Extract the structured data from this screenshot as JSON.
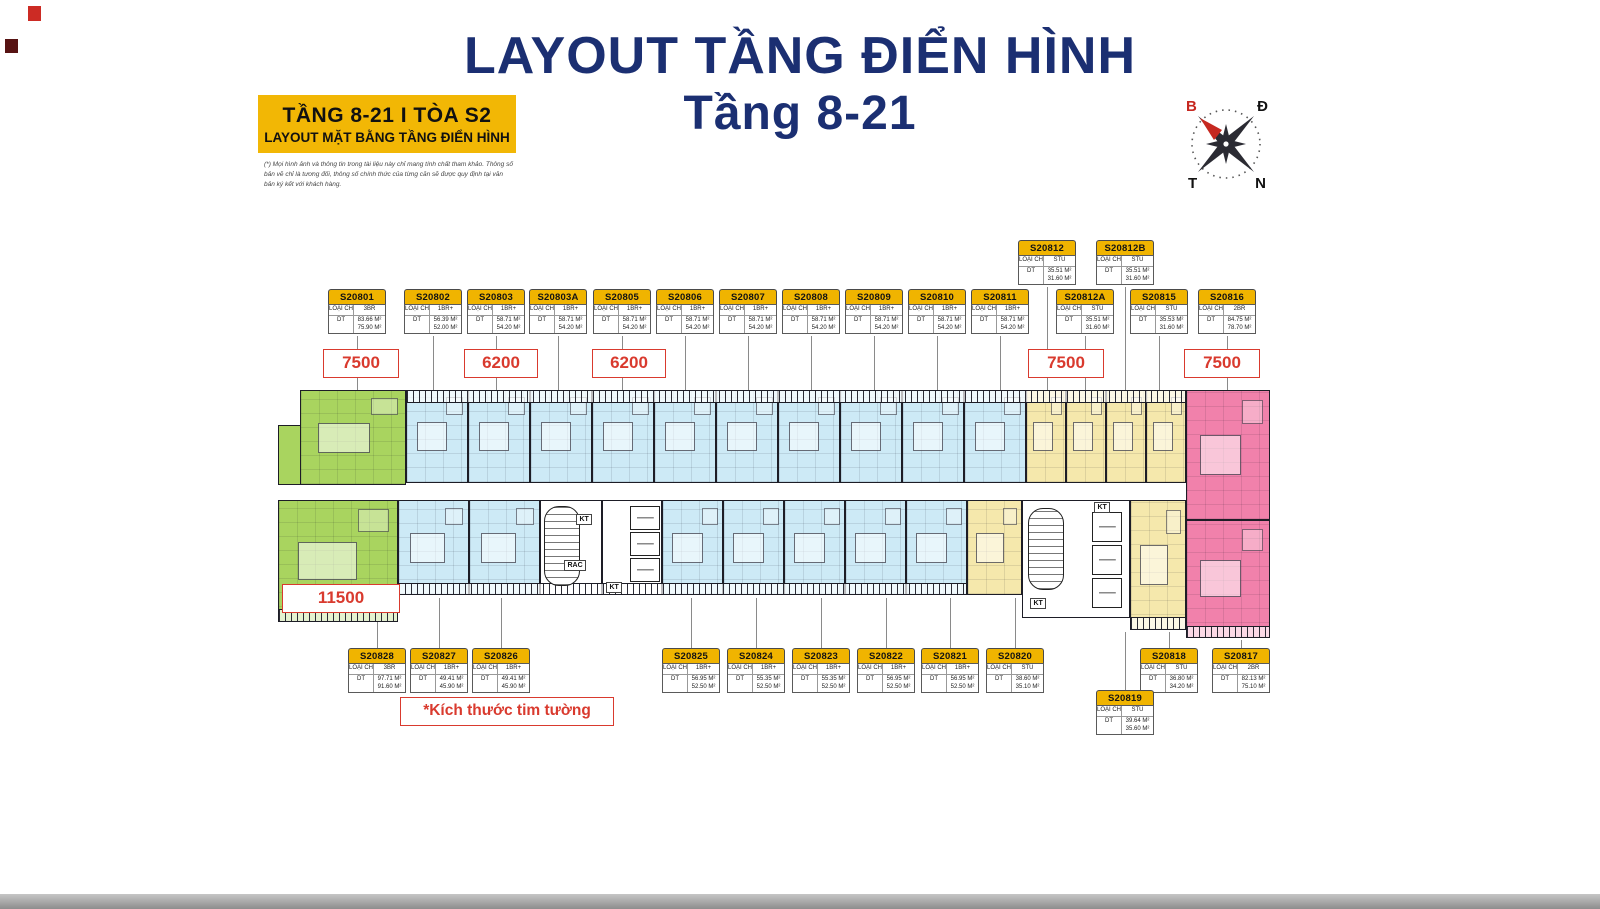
{
  "page": {
    "title_line1": "LAYOUT TẦNG ĐIỂN HÌNH",
    "title_line2": "Tầng 8-21"
  },
  "badge": {
    "line1": "TẦNG 8-21 I TÒA S2",
    "line2": "LAYOUT MẶT BẰNG TẦNG ĐIỂN HÌNH",
    "disclaimer": "(*) Mọi hình ảnh và thông tin trong tài liệu này chỉ mang tính chất tham khảo. Thông số bản vẽ chỉ là tương đối, thông số chính thức của từng căn sẽ được quy định tại văn bản ký kết với khách hàng."
  },
  "compass": {
    "north": "B",
    "east": "Đ",
    "west": "T",
    "south": "N"
  },
  "note": {
    "text": "*Kích thước tim tường"
  },
  "table_labels": {
    "type_label": "LOẠI CH",
    "area_label": "DT"
  },
  "colors": {
    "title_navy": "#1b2f72",
    "card_header_gold": "#f0b400",
    "badge_gold": "#f2b705",
    "dim_red": "#d93a2e",
    "unit_green": "#a9d45f",
    "unit_blue": "#cdeaf6",
    "unit_yellow": "#f5e8ac",
    "unit_pink": "#f181ab"
  },
  "units": [
    {
      "id": "S20801",
      "type": "3BR",
      "area1": "83.66 M²",
      "area2": "75.90 M²",
      "x": 328,
      "y": 289,
      "ly1": 336,
      "ly2": 390
    },
    {
      "id": "S20802",
      "type": "1BR+",
      "area1": "56.39 M²",
      "area2": "52.00 M²",
      "x": 404,
      "y": 289,
      "ly1": 336,
      "ly2": 390
    },
    {
      "id": "S20803",
      "type": "1BR+",
      "area1": "58.71 M²",
      "area2": "54.20 M²",
      "x": 467,
      "y": 289,
      "ly1": 336,
      "ly2": 390
    },
    {
      "id": "S20803A",
      "type": "1BR+",
      "area1": "58.71 M²",
      "area2": "54.20 M²",
      "x": 529,
      "y": 289,
      "ly1": 336,
      "ly2": 390
    },
    {
      "id": "S20805",
      "type": "1BR+",
      "area1": "58.71 M²",
      "area2": "54.20 M²",
      "x": 593,
      "y": 289,
      "ly1": 336,
      "ly2": 390
    },
    {
      "id": "S20806",
      "type": "1BR+",
      "area1": "58.71 M²",
      "area2": "54.20 M²",
      "x": 656,
      "y": 289,
      "ly1": 336,
      "ly2": 390
    },
    {
      "id": "S20807",
      "type": "1BR+",
      "area1": "58.71 M²",
      "area2": "54.20 M²",
      "x": 719,
      "y": 289,
      "ly1": 336,
      "ly2": 390
    },
    {
      "id": "S20808",
      "type": "1BR+",
      "area1": "58.71 M²",
      "area2": "54.20 M²",
      "x": 782,
      "y": 289,
      "ly1": 336,
      "ly2": 390
    },
    {
      "id": "S20809",
      "type": "1BR+",
      "area1": "58.71 M²",
      "area2": "54.20 M²",
      "x": 845,
      "y": 289,
      "ly1": 336,
      "ly2": 390
    },
    {
      "id": "S20810",
      "type": "1BR+",
      "area1": "58.71 M²",
      "area2": "54.20 M²",
      "x": 908,
      "y": 289,
      "ly1": 336,
      "ly2": 390
    },
    {
      "id": "S20811",
      "type": "1BR+",
      "area1": "58.71 M²",
      "area2": "54.20 M²",
      "x": 971,
      "y": 289,
      "ly1": 336,
      "ly2": 390
    },
    {
      "id": "S20812",
      "type": "STU",
      "area1": "35.51 M²",
      "area2": "31.60 M²",
      "x": 1018,
      "y": 240,
      "ly1": 287,
      "ly2": 390
    },
    {
      "id": "S20812B",
      "type": "STU",
      "area1": "35.51 M²",
      "area2": "31.60 M²",
      "x": 1096,
      "y": 240,
      "ly1": 287,
      "ly2": 390
    },
    {
      "id": "S20812A",
      "type": "STU",
      "area1": "35.51 M²",
      "area2": "31.60 M²",
      "x": 1056,
      "y": 289,
      "ly1": 336,
      "ly2": 390
    },
    {
      "id": "S20815",
      "type": "STU",
      "area1": "35.53 M²",
      "area2": "31.60 M²",
      "x": 1130,
      "y": 289,
      "ly1": 336,
      "ly2": 390
    },
    {
      "id": "S20816",
      "type": "2BR",
      "area1": "84.75 M²",
      "area2": "78.70 M²",
      "x": 1198,
      "y": 289,
      "ly1": 336,
      "ly2": 390
    },
    {
      "id": "S20828",
      "type": "3BR",
      "area1": "97.71 M²",
      "area2": "91.60 M²",
      "x": 348,
      "y": 648,
      "ly1": 615,
      "ly2": 648
    },
    {
      "id": "S20827",
      "type": "1BR+",
      "area1": "49.41 M²",
      "area2": "45.90 M²",
      "x": 410,
      "y": 648,
      "ly1": 598,
      "ly2": 648
    },
    {
      "id": "S20826",
      "type": "1BR+",
      "area1": "49.41 M²",
      "area2": "45.90 M²",
      "x": 472,
      "y": 648,
      "ly1": 598,
      "ly2": 648
    },
    {
      "id": "S20825",
      "type": "1BR+",
      "area1": "56.95 M²",
      "area2": "52.50 M²",
      "x": 662,
      "y": 648,
      "ly1": 598,
      "ly2": 648
    },
    {
      "id": "S20824",
      "type": "1BR+",
      "area1": "55.35 M²",
      "area2": "52.50 M²",
      "x": 727,
      "y": 648,
      "ly1": 598,
      "ly2": 648
    },
    {
      "id": "S20823",
      "type": "1BR+",
      "area1": "55.35 M²",
      "area2": "52.50 M²",
      "x": 792,
      "y": 648,
      "ly1": 598,
      "ly2": 648
    },
    {
      "id": "S20822",
      "type": "1BR+",
      "area1": "56.95 M²",
      "area2": "52.50 M²",
      "x": 857,
      "y": 648,
      "ly1": 598,
      "ly2": 648
    },
    {
      "id": "S20821",
      "type": "1BR+",
      "area1": "56.95 M²",
      "area2": "52.50 M²",
      "x": 921,
      "y": 648,
      "ly1": 598,
      "ly2": 648
    },
    {
      "id": "S20820",
      "type": "STU",
      "area1": "38.60 M²",
      "area2": "35.10 M²",
      "x": 986,
      "y": 648,
      "ly1": 598,
      "ly2": 648
    },
    {
      "id": "S20818",
      "type": "STU",
      "area1": "36.80 M²",
      "area2": "34.20 M²",
      "x": 1140,
      "y": 648,
      "ly1": 632,
      "ly2": 648
    },
    {
      "id": "S20817",
      "type": "2BR",
      "area1": "82.13 M²",
      "area2": "75.10 M²",
      "x": 1212,
      "y": 648,
      "ly1": 640,
      "ly2": 648
    },
    {
      "id": "S20819",
      "type": "STU",
      "area1": "39.64 M²",
      "area2": "35.60 M²",
      "x": 1096,
      "y": 690,
      "ly1": 632,
      "ly2": 690
    }
  ],
  "dimensions": [
    {
      "label": "7500",
      "x": 323,
      "y": 349,
      "w": 74
    },
    {
      "label": "6200",
      "x": 464,
      "y": 349,
      "w": 72
    },
    {
      "label": "6200",
      "x": 592,
      "y": 349,
      "w": 72
    },
    {
      "label": "7500",
      "x": 1028,
      "y": 349,
      "w": 74
    },
    {
      "label": "7500",
      "x": 1184,
      "y": 349,
      "w": 74
    },
    {
      "label": "11500",
      "x": 282,
      "y": 584,
      "w": 116
    }
  ],
  "plan": {
    "blocks": [
      {
        "x": 300,
        "y": 390,
        "w": 106,
        "h": 95,
        "c": "green",
        "tex": true
      },
      {
        "x": 278,
        "y": 425,
        "w": 23,
        "h": 60,
        "c": "green",
        "tex": false
      },
      {
        "x": 406,
        "y": 390,
        "w": 62,
        "h": 93,
        "c": "blue",
        "tex": true
      },
      {
        "x": 468,
        "y": 390,
        "w": 62,
        "h": 93,
        "c": "blue",
        "tex": true
      },
      {
        "x": 530,
        "y": 390,
        "w": 62,
        "h": 93,
        "c": "blue",
        "tex": true
      },
      {
        "x": 592,
        "y": 390,
        "w": 62,
        "h": 93,
        "c": "blue",
        "tex": true
      },
      {
        "x": 654,
        "y": 390,
        "w": 62,
        "h": 93,
        "c": "blue",
        "tex": true
      },
      {
        "x": 716,
        "y": 390,
        "w": 62,
        "h": 93,
        "c": "blue",
        "tex": true
      },
      {
        "x": 778,
        "y": 390,
        "w": 62,
        "h": 93,
        "c": "blue",
        "tex": true
      },
      {
        "x": 840,
        "y": 390,
        "w": 62,
        "h": 93,
        "c": "blue",
        "tex": true
      },
      {
        "x": 902,
        "y": 390,
        "w": 62,
        "h": 93,
        "c": "blue",
        "tex": true
      },
      {
        "x": 964,
        "y": 390,
        "w": 62,
        "h": 93,
        "c": "blue",
        "tex": true
      },
      {
        "x": 1026,
        "y": 390,
        "w": 40,
        "h": 93,
        "c": "yellow",
        "tex": true
      },
      {
        "x": 1066,
        "y": 390,
        "w": 40,
        "h": 93,
        "c": "yellow",
        "tex": true
      },
      {
        "x": 1106,
        "y": 390,
        "w": 40,
        "h": 93,
        "c": "yellow",
        "tex": true
      },
      {
        "x": 1146,
        "y": 390,
        "w": 40,
        "h": 93,
        "c": "yellow",
        "tex": true
      },
      {
        "x": 1186,
        "y": 390,
        "w": 84,
        "h": 130,
        "c": "pink",
        "tex": true
      },
      {
        "x": 278,
        "y": 500,
        "w": 120,
        "h": 122,
        "c": "green",
        "tex": true
      },
      {
        "x": 398,
        "y": 500,
        "w": 71,
        "h": 95,
        "c": "blue",
        "tex": true
      },
      {
        "x": 469,
        "y": 500,
        "w": 71,
        "h": 95,
        "c": "blue",
        "tex": true
      },
      {
        "x": 540,
        "y": 500,
        "w": 62,
        "h": 95,
        "c": "white",
        "tex": false
      },
      {
        "x": 602,
        "y": 500,
        "w": 60,
        "h": 95,
        "c": "white",
        "tex": false
      },
      {
        "x": 662,
        "y": 500,
        "w": 61,
        "h": 95,
        "c": "blue",
        "tex": true
      },
      {
        "x": 723,
        "y": 500,
        "w": 61,
        "h": 95,
        "c": "blue",
        "tex": true
      },
      {
        "x": 784,
        "y": 500,
        "w": 61,
        "h": 95,
        "c": "blue",
        "tex": true
      },
      {
        "x": 845,
        "y": 500,
        "w": 61,
        "h": 95,
        "c": "blue",
        "tex": true
      },
      {
        "x": 906,
        "y": 500,
        "w": 61,
        "h": 95,
        "c": "blue",
        "tex": true
      },
      {
        "x": 967,
        "y": 500,
        "w": 55,
        "h": 95,
        "c": "yellow",
        "tex": true
      },
      {
        "x": 1022,
        "y": 500,
        "w": 108,
        "h": 118,
        "c": "white",
        "tex": false
      },
      {
        "x": 1130,
        "y": 500,
        "w": 56,
        "h": 130,
        "c": "yellow",
        "tex": true
      },
      {
        "x": 1186,
        "y": 520,
        "w": 84,
        "h": 118,
        "c": "pink",
        "tex": true
      }
    ],
    "hatches": [
      {
        "x": 406,
        "y": 390,
        "w": 780,
        "h": 13
      },
      {
        "x": 398,
        "y": 583,
        "w": 569,
        "h": 12
      },
      {
        "x": 278,
        "y": 609,
        "w": 120,
        "h": 13
      },
      {
        "x": 1130,
        "y": 617,
        "w": 56,
        "h": 13
      },
      {
        "x": 1186,
        "y": 626,
        "w": 84,
        "h": 12
      }
    ],
    "stairs": [
      {
        "x": 544,
        "y": 506,
        "w": 36,
        "h": 80
      },
      {
        "x": 1028,
        "y": 508,
        "w": 36,
        "h": 82
      }
    ],
    "lifts": [
      {
        "x": 630,
        "y": 506,
        "w": 30,
        "h": 24
      },
      {
        "x": 630,
        "y": 532,
        "w": 30,
        "h": 24
      },
      {
        "x": 630,
        "y": 558,
        "w": 30,
        "h": 24
      },
      {
        "x": 1092,
        "y": 512,
        "w": 30,
        "h": 30
      },
      {
        "x": 1092,
        "y": 545,
        "w": 30,
        "h": 30
      },
      {
        "x": 1092,
        "y": 578,
        "w": 30,
        "h": 30
      }
    ],
    "core_labels": [
      {
        "text": "KT",
        "x": 576,
        "y": 514
      },
      {
        "text": "RAC",
        "x": 564,
        "y": 560
      },
      {
        "text": "KT",
        "x": 606,
        "y": 582
      },
      {
        "text": "KT",
        "x": 1094,
        "y": 502
      },
      {
        "text": "KT",
        "x": 1030,
        "y": 598
      }
    ]
  }
}
